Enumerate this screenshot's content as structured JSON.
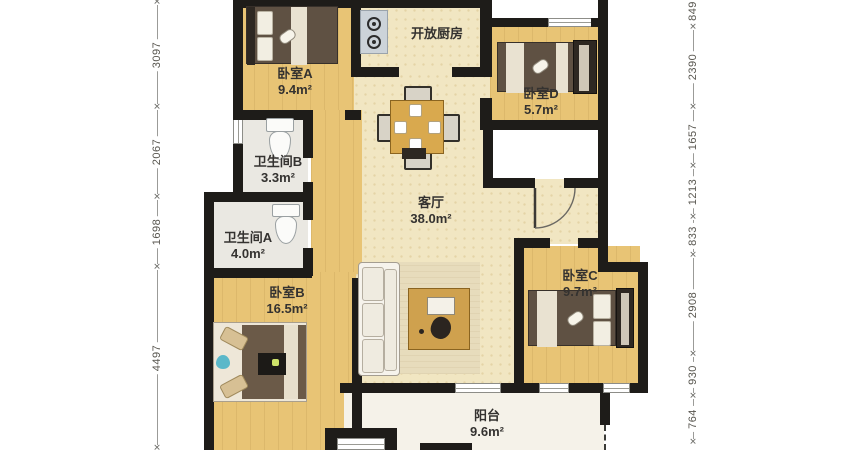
{
  "plan": {
    "type": "apartment-floor-plan",
    "rooms": {
      "bedroom_a": {
        "name": "卧室A",
        "area": "9.4m²"
      },
      "open_kitchen": {
        "name": "开放厨房",
        "area": ""
      },
      "bedroom_d": {
        "name": "卧室D",
        "area": "5.7m²"
      },
      "bathroom_b": {
        "name": "卫生间B",
        "area": "3.3m²"
      },
      "bathroom_a": {
        "name": "卫生间A",
        "area": "4.0m²"
      },
      "living_room": {
        "name": "客厅",
        "area": "38.0m²"
      },
      "bedroom_c": {
        "name": "卧室C",
        "area": "9.7m²"
      },
      "bedroom_b": {
        "name": "卧室B",
        "area": "16.5m²"
      },
      "balcony": {
        "name": "阳台",
        "area": "9.6m²"
      }
    },
    "dimensions_mm": {
      "left": [
        "3097",
        "2067",
        "1698",
        "4497"
      ],
      "right": [
        "849",
        "2390",
        "1657",
        "1213",
        "833",
        "2908",
        "930",
        "764"
      ]
    },
    "colors": {
      "wall": "#1e1c19",
      "wood_floor": "#e8c475",
      "living_floor": "#f1e6c2",
      "bath_floor": "#eae8e2",
      "balcony_floor": "#f5f2e9"
    }
  }
}
